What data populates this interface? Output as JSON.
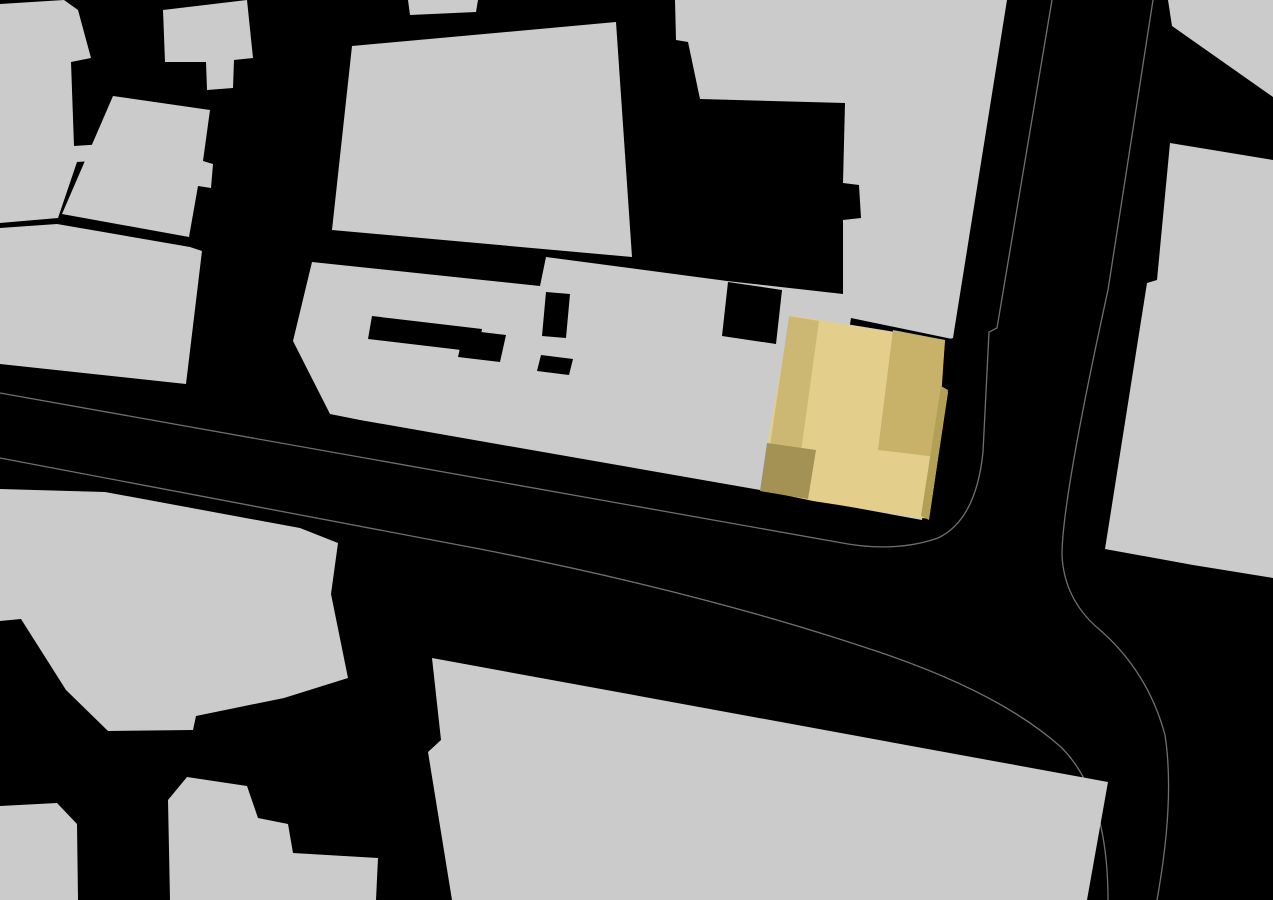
{
  "map": {
    "width": 1273,
    "height": 900,
    "colors": {
      "background": "#000000",
      "building": "#cbcbcb",
      "road_line": "#6f6f6f",
      "highlight_light": "#e3ce8c",
      "highlight_mid_left": "#cdb873",
      "highlight_mid_right": "#c8b26a",
      "highlight_dark": "#a39254",
      "highlight_edge": "#b2a057"
    },
    "roads": [
      {
        "name": "road-edge-west",
        "d": "M 1052,0 L 997,328 L 989,332 L 983,452 Q 976,520 938,538 Q 898,552 848,544 L 0,393"
      },
      {
        "name": "road-edge-south",
        "d": "M 0,458 L 480,549 Q 700,592 873,650 Q 1000,692 1062,748 Q 1108,795 1108,900"
      },
      {
        "name": "road-edge-east",
        "d": "M 1153,0 L 1108,290 Q 1062,500 1062,555 Q 1064,600 1100,630 Q 1148,672 1165,735 Q 1175,800 1157,900"
      }
    ],
    "buildings": [
      {
        "name": "building-block-northwest-corner",
        "points": "0,4 64,0 78,10 91,58 71,62 74,146 104,144 108,160 77,162 58,218 0,223"
      },
      {
        "name": "building-block-north-bar",
        "points": "163,10 247,0 253,58 234,60 233,88 207,90 206,62 165,62"
      },
      {
        "name": "building-block-top-sliver",
        "points": "408,0 478,0 476,12 410,15"
      },
      {
        "name": "building-block-west-mid",
        "points": "113,96 210,110 203,161 213,164 211,188 198,186 189,237 62,214"
      },
      {
        "name": "building-block-west-lower",
        "points": "0,228 57,224 190,247 202,251 186,384 0,364"
      },
      {
        "name": "building-block-center-north",
        "points": "352,46 616,22 632,257 332,230"
      },
      {
        "name": "building-complex-center",
        "points": "312,262 540,286 546,257 727,281 843,294 843,220 861,218 859,185 843,183 845,103 700,99 688,42 676,40 675,0 1007,0 953,338 945,341 922,520 813,500 760,490 360,420 330,414 293,341"
      },
      {
        "name": "building-block-southwest-large",
        "points": "0,489 105,492 300,528 338,543 331,594 348,678 284,698 196,716 193,730 108,731 66,690 21,619 0,621"
      },
      {
        "name": "building-block-southwest-corner",
        "points": "0,806 57,803 77,824 78,900 0,900"
      },
      {
        "name": "building-block-south-cluster",
        "points": "168,800 187,777 247,786 258,818 288,824 293,853 378,858 376,900 170,900"
      },
      {
        "name": "building-block-south-large",
        "points": "432,658 1108,782 1087,900 452,900 428,752 441,740"
      },
      {
        "name": "building-block-northeast-corner",
        "points": "1168,0 1273,0 1273,97 1172,26"
      },
      {
        "name": "building-block-east-long",
        "points": "1170,143 1273,160 1273,578 1193,565 1105,549 1147,283 1157,280"
      }
    ],
    "cutouts": [
      {
        "name": "courtyard-cutout-protrusion",
        "points": "728,282 782,290 776,344 722,336"
      },
      {
        "name": "courtyard-cutout-hook-bar",
        "points": "372,316 482,329 478,352 368,339"
      },
      {
        "name": "courtyard-cutout-hook-column",
        "points": "464,330 506,335 500,362 458,357"
      },
      {
        "name": "courtyard-cutout-bar",
        "points": "546,292 570,294 566,338 542,336"
      },
      {
        "name": "courtyard-cutout-square",
        "points": "541,355 573,359 569,375 537,371"
      },
      {
        "name": "gap-cutout-above-highlight",
        "points": "851,318 957,340 955,356 849,331"
      }
    ],
    "highlight": {
      "name": "highlighted-building",
      "parts": [
        {
          "name": "highlight-roof-main",
          "points": "790,315 945,340 941,388 948,392 929,519 813,501 761,490 767,443",
          "fill_key": "highlight_light"
        },
        {
          "name": "highlight-roof-left-wing",
          "points": "789,316 819,321 801,452 770,446",
          "fill_key": "highlight_mid_left"
        },
        {
          "name": "highlight-roof-right-wing",
          "points": "893,330 945,340 937,457 878,450",
          "fill_key": "highlight_mid_right"
        },
        {
          "name": "highlight-roof-southwest-block",
          "points": "767,443 816,450 808,499 760,491",
          "fill_key": "highlight_dark"
        },
        {
          "name": "highlight-east-facade-edge",
          "points": "941,386 948,390 929,520 921,516",
          "fill_key": "highlight_edge"
        }
      ]
    }
  }
}
